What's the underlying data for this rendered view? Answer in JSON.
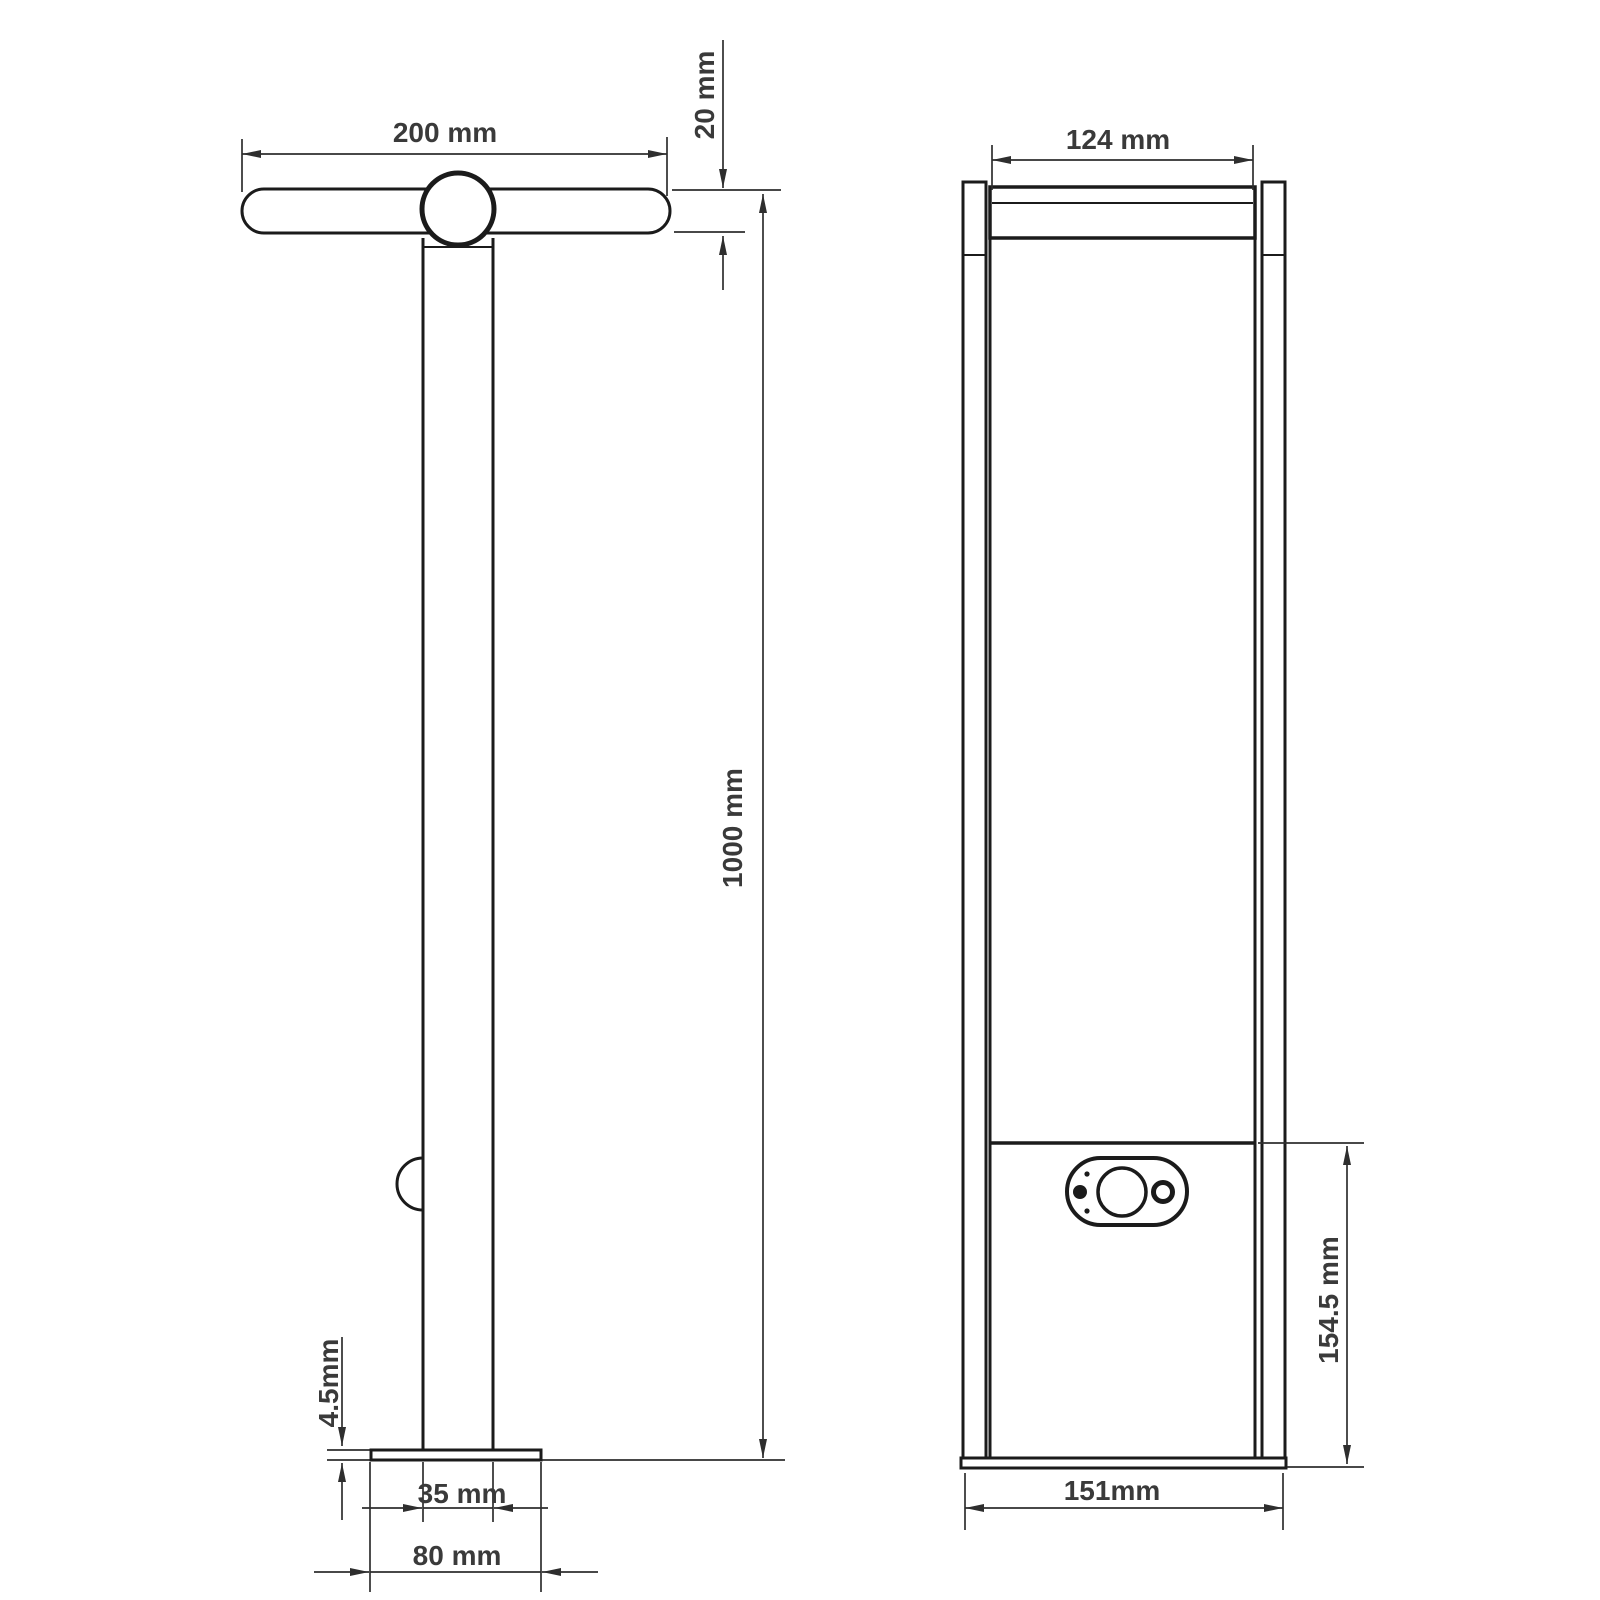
{
  "views": {
    "side": {
      "title": "side-view",
      "dims": {
        "bar_length": "200 mm",
        "bar_thickness": "20 mm",
        "overall_height": "1000 mm",
        "base_plate_thickness": "4.5mm",
        "pole_depth": "35 mm",
        "base_plate_depth": "80 mm"
      }
    },
    "front": {
      "title": "front-view",
      "dims": {
        "light_bar_width": "124 mm",
        "control_section_height": "154.5 mm",
        "body_width": "151mm"
      }
    }
  },
  "colors": {
    "background": "#ffffff",
    "part_line": "#1b1b1b",
    "dimension_line": "#2e2e2e",
    "text": "#3a3a3a"
  }
}
